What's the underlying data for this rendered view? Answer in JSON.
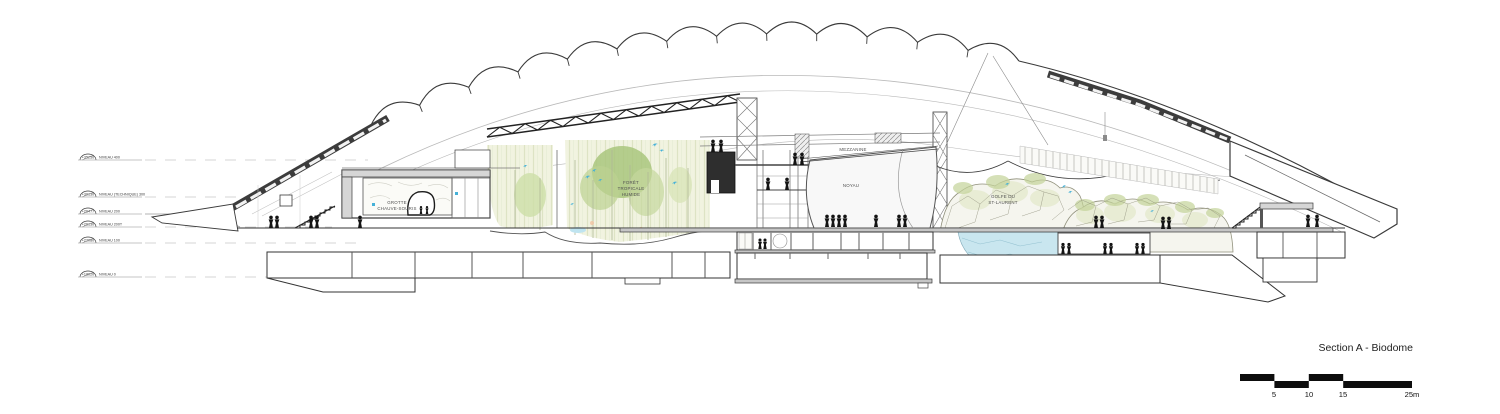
{
  "title_block": {
    "title": "Section A - Biodome",
    "scale_labels": [
      "5",
      "10",
      "15",
      "25m"
    ]
  },
  "levels": [
    {
      "elevation": "+35250",
      "name": "NIVEAU 400"
    },
    {
      "elevation": "+30130",
      "name": "NIVEAU (TECHNIQUE) 300"
    },
    {
      "elevation": "+26477",
      "name": "NIVEAU 200"
    },
    {
      "elevation": "+26130",
      "name": "NIVEAU 200T"
    },
    {
      "elevation": "+22080",
      "name": "NIVEAU 100"
    },
    {
      "elevation": "+18020",
      "name": "NIVEAU 0"
    }
  ],
  "rooms": {
    "grotte": {
      "line1": "GROTTE",
      "line2": "CHAUVE-SOURIS"
    },
    "foret": {
      "line1": "FORÊT",
      "line2": "TROPICALE",
      "line3": "HUMIDE"
    },
    "mezzanine": "MEZZANINE",
    "noyau": "NOYAU",
    "golfe": {
      "line1": "GOLFE DU",
      "line2": "ST-LAURENT"
    }
  },
  "icons": {
    "person": "human-silhouette",
    "bird": "flying-bird"
  },
  "colors": {
    "line": "#3a3a3a",
    "wall_fill": "#d6d6d6",
    "slab_fill": "#c6c6c6",
    "dark_steel": "#2e2e2e",
    "forest_green": "#aec879",
    "rock_line": "#8f8f7a",
    "rock_tint": "#dde3c0",
    "water": "#c9e6ef",
    "bird_blue": "#45b1d8",
    "people": "#141414"
  }
}
